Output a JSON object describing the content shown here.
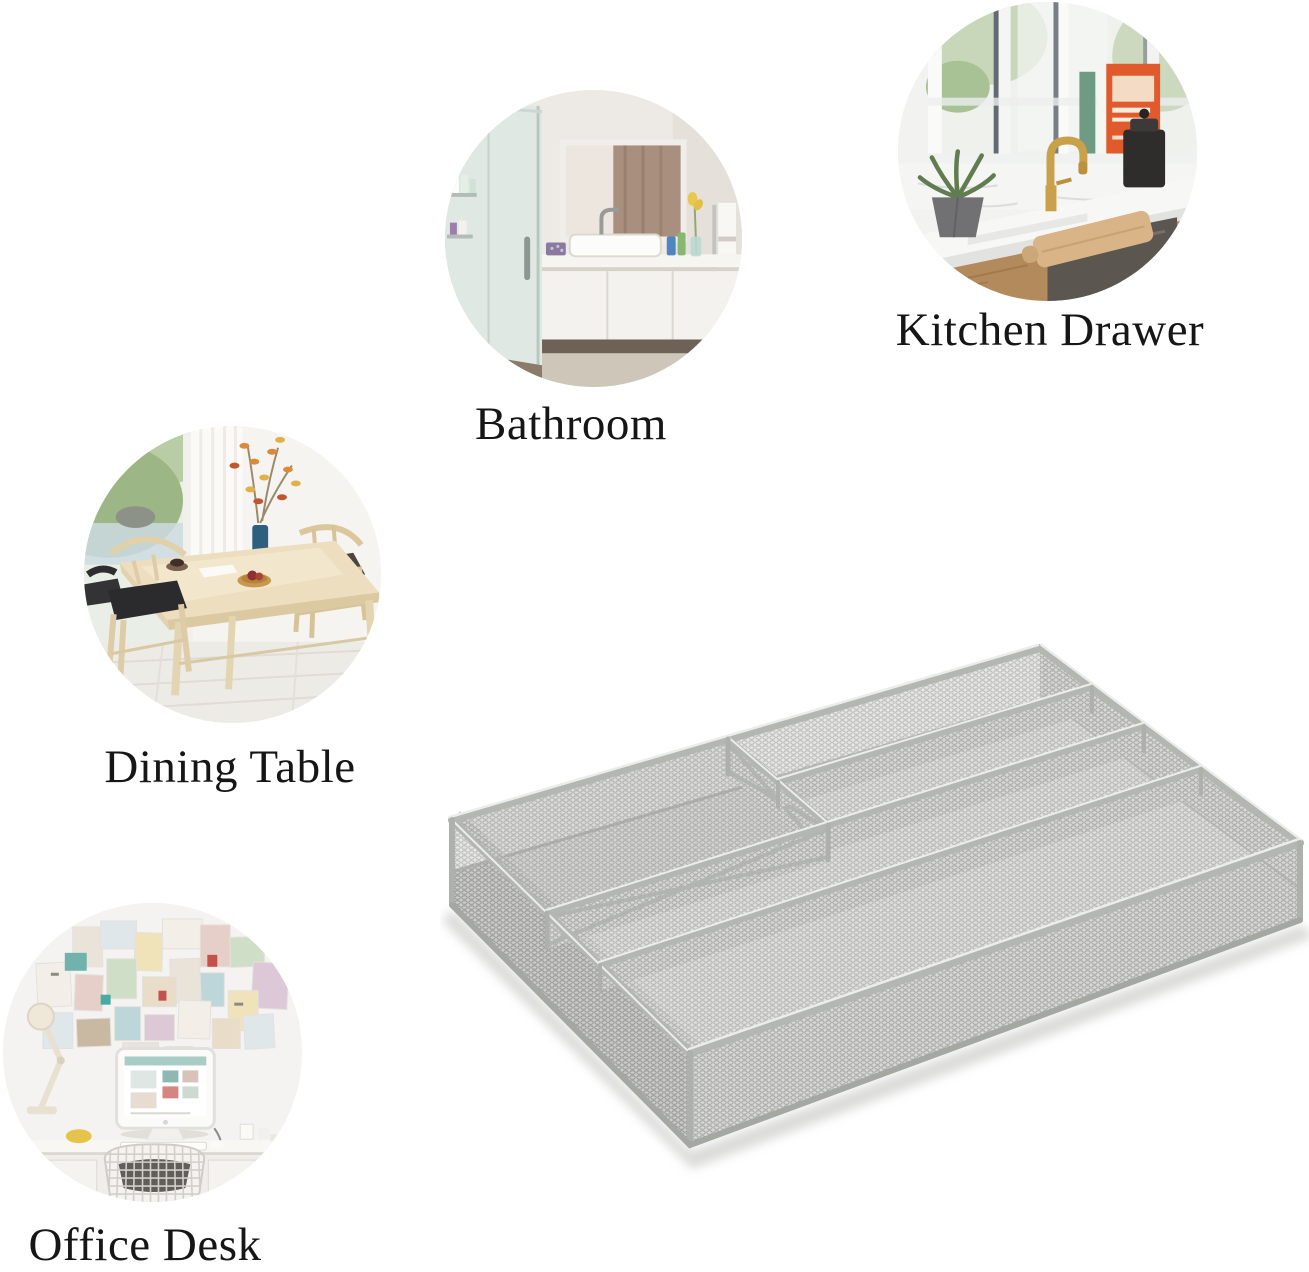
{
  "page": {
    "background": "#ffffff",
    "text_color": "#161616"
  },
  "scenes": [
    {
      "id": "bathroom",
      "label": "Bathroom"
    },
    {
      "id": "kitchen-drawer",
      "label": "Kitchen Drawer"
    },
    {
      "id": "dining-table",
      "label": "Dining Table"
    },
    {
      "id": "office-desk",
      "label": "Office Desk"
    }
  ],
  "product": {
    "kind": "silver-mesh-cutlery-tray",
    "finish_color": "#c9cbc7"
  }
}
